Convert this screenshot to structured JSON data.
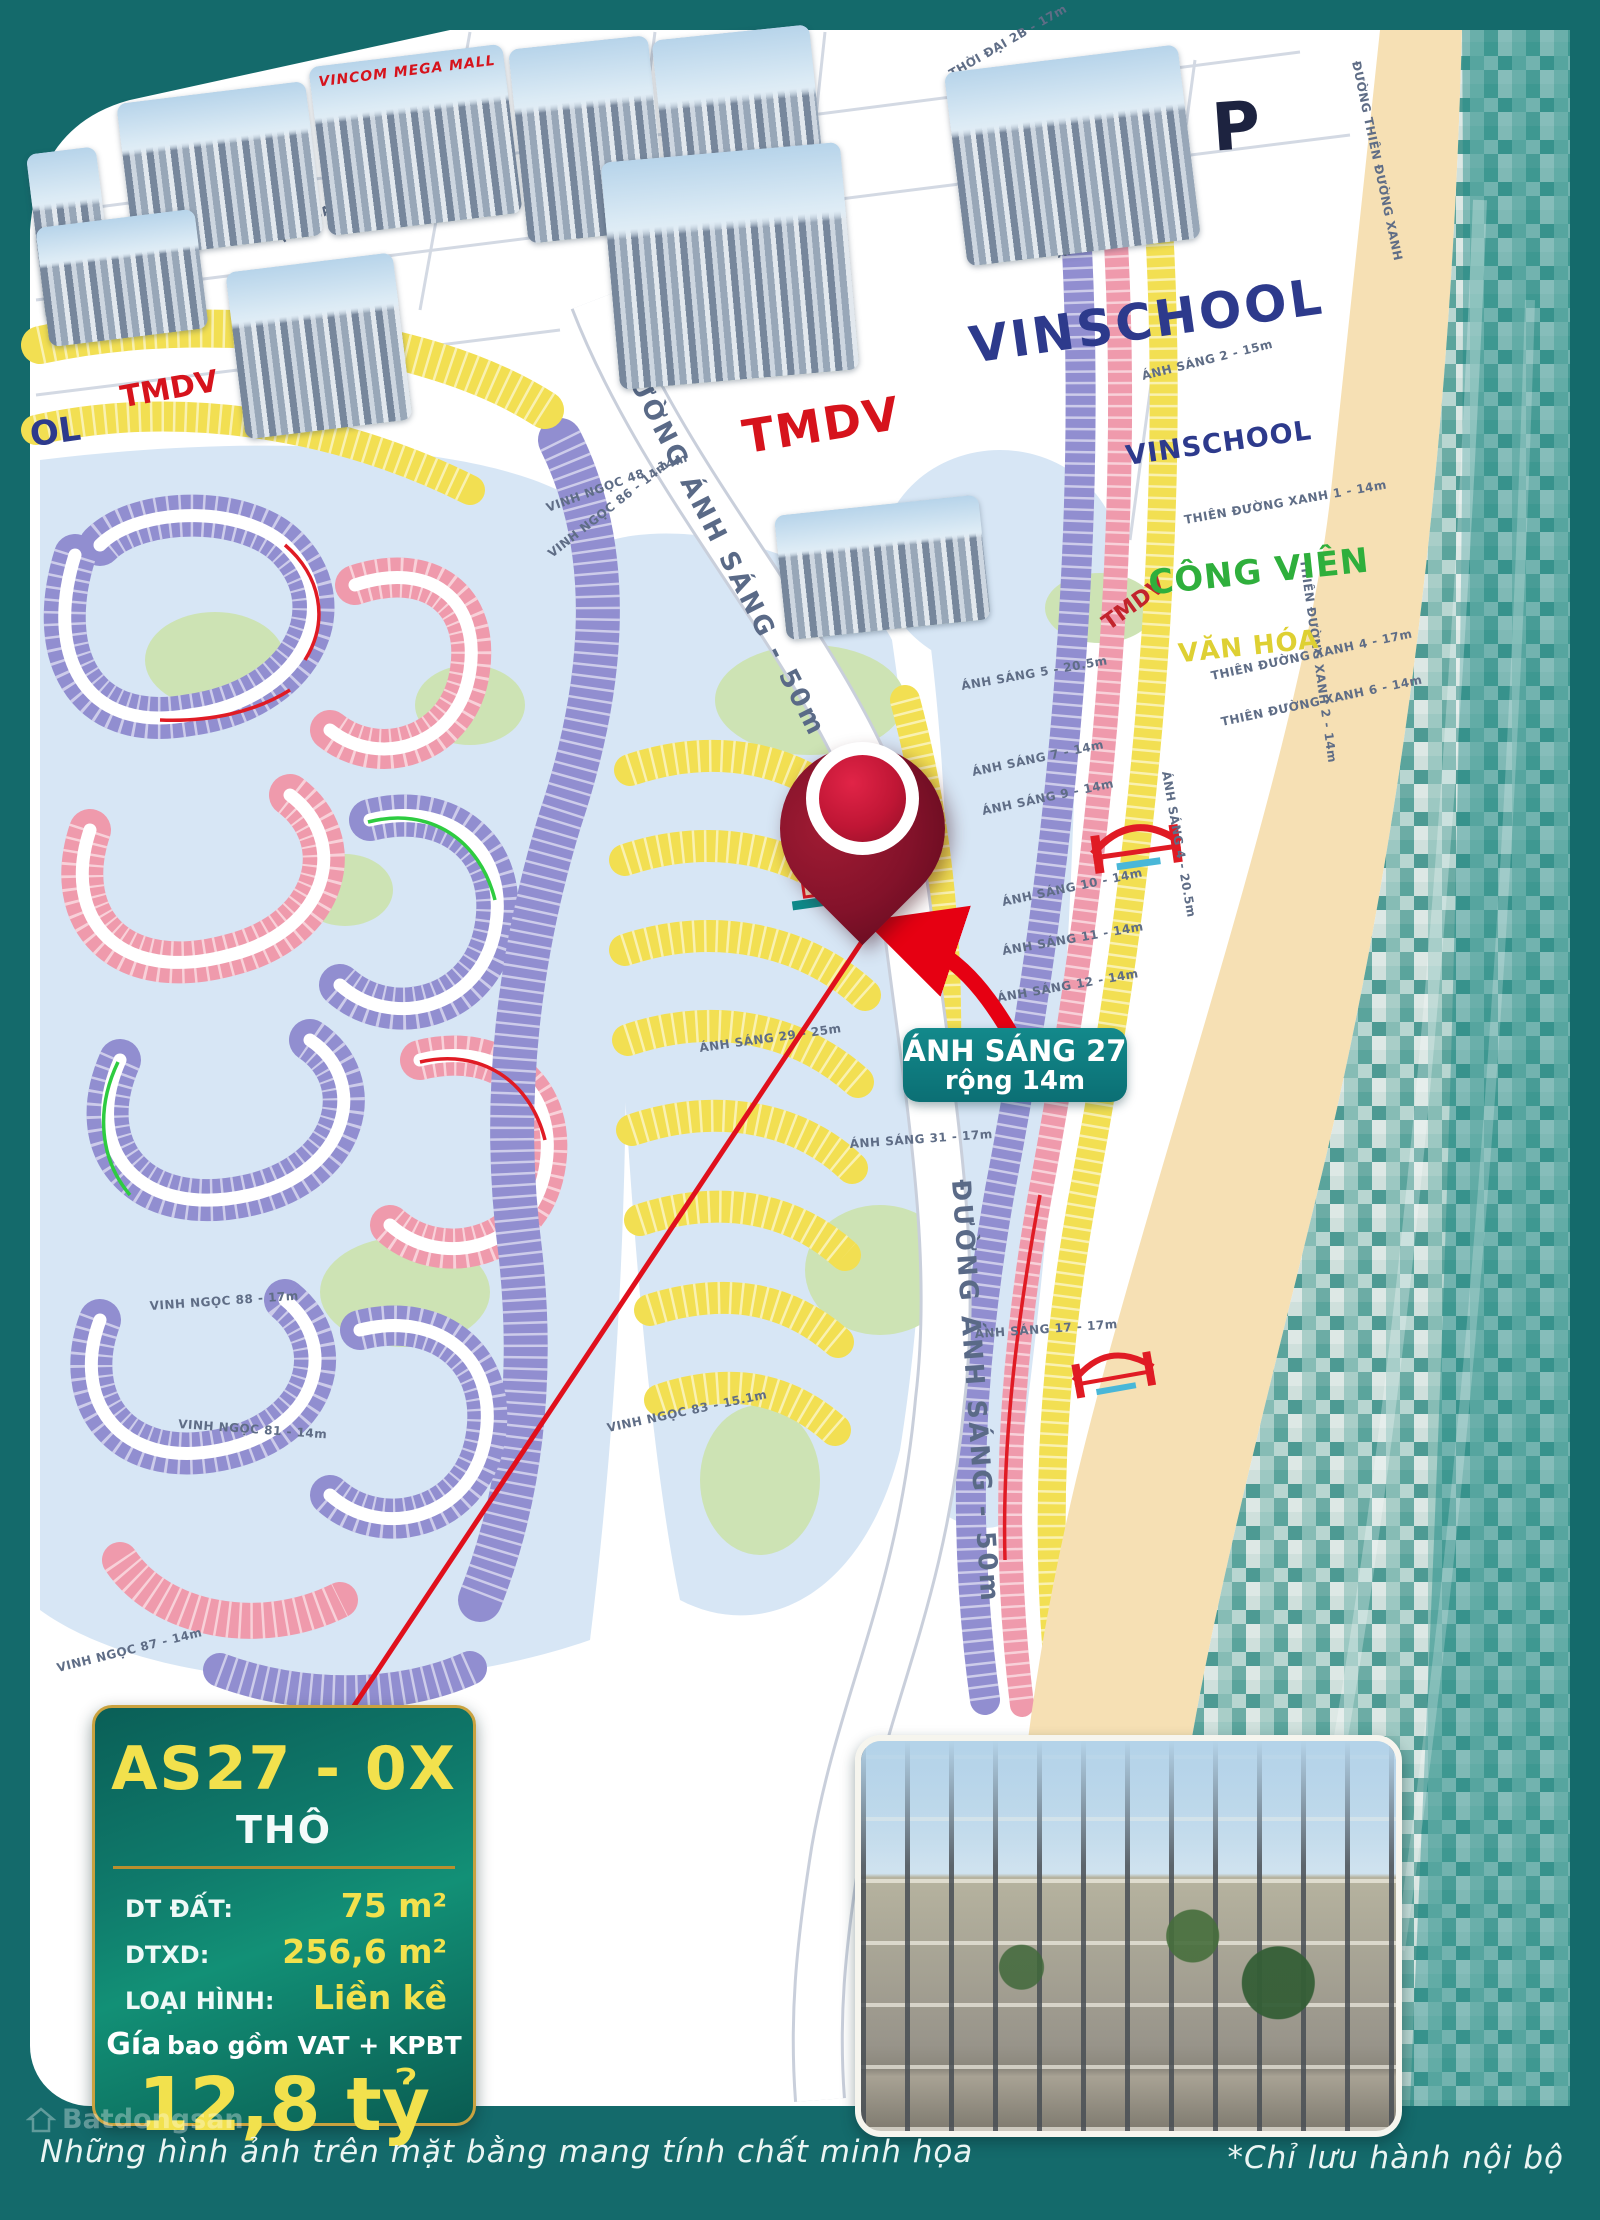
{
  "frame": {
    "caption_left": "Những hình ảnh trên mặt bằng mang tính chất minh họa",
    "caption_right": "*Chỉ lưu hành nội bộ",
    "watermark": "Batdongsan"
  },
  "zones": {
    "vincom_mega_mall": "VINCOM MEGA MALL",
    "tmdv_left": "TMDV",
    "tmdv_center": "TMDV",
    "tmdv_small": "TMDV",
    "vinschool_big": "VINSCHOOL",
    "vinschool_small": "VINSCHOOL",
    "vinschool_clipped": "OL",
    "parking": "P",
    "cong_vien": "CÔNG VIÊN",
    "van_hoa": "VĂN HÓA"
  },
  "roads": {
    "main": "ĐƯỜNG ÁNH SÁNG - 50m"
  },
  "streets": [
    {
      "label": "VINH NGỌC 48 - 14m"
    },
    {
      "label": "VINH NGỌC 86 - 14m"
    },
    {
      "label": "VINH NGỌC 88 - 17m"
    },
    {
      "label": "VINH NGỌC 81 - 14m"
    },
    {
      "label": "VINH NGỌC 83 - 15.1m"
    },
    {
      "label": "VINH NGỌC 87 - 14m"
    },
    {
      "label": "ÁNH SÁNG 1 - 26m"
    },
    {
      "label": "ÁNH SÁNG 2 - 15m"
    },
    {
      "label": "ÁNH SÁNG 5 - 20.5m"
    },
    {
      "label": "ÁNH SÁNG 7 - 14m"
    },
    {
      "label": "ÁNH SÁNG 9 - 14m"
    },
    {
      "label": "ÁNH SÁNG 10 - 14m"
    },
    {
      "label": "ÁNH SÁNG 11 - 14m"
    },
    {
      "label": "ÁNH SÁNG 12 - 14m"
    },
    {
      "label": "ÁNH SÁNG 17 - 17m"
    },
    {
      "label": "ÁNH SÁNG 29 - 25m"
    },
    {
      "label": "ÁNH SÁNG 31 - 17m"
    },
    {
      "label": "ÁNH SÁNG 4 - 20.5m"
    },
    {
      "label": "THIÊN ĐƯỜNG XANH 1 - 14m"
    },
    {
      "label": "THIÊN ĐƯỜNG XANH 2 - 14m"
    },
    {
      "label": "THIÊN ĐƯỜNG XANH 4 - 17m"
    },
    {
      "label": "THIÊN ĐƯỜNG XANH 6 - 14m"
    },
    {
      "label": "THỜI ĐẠI 13 - 20m"
    },
    {
      "label": "THỜI ĐẠI 2B - 17m"
    },
    {
      "label": "ĐƯỜNG THIÊN ĐƯỜNG XANH"
    }
  ],
  "callout": {
    "line1": "ÁNH SÁNG 27",
    "line2": "rộng 14m"
  },
  "card": {
    "title": "AS27 - 0X",
    "subtitle": "THÔ",
    "rows": [
      {
        "label": "DT ĐẤT:",
        "value": "75 m²"
      },
      {
        "label": "DTXD:",
        "value": "256,6 m²"
      },
      {
        "label": "LOẠI HÌNH:",
        "value": "Liền kề"
      }
    ],
    "price_label_prefix": "Gía",
    "price_label_rest": "bao gồm VAT + KPBT",
    "price": "12,8 tỷ"
  },
  "colors": {
    "frame_teal": "#146a6b",
    "sand": "#f6e0b4",
    "water": "#7ab5ae",
    "parcel_purple": "#918ed0",
    "parcel_pink": "#ef9aac",
    "parcel_yellow": "#f2df52",
    "pin_red": "#83122a",
    "arrow_red": "#e60012",
    "accent_yellow": "#f2e14d"
  }
}
